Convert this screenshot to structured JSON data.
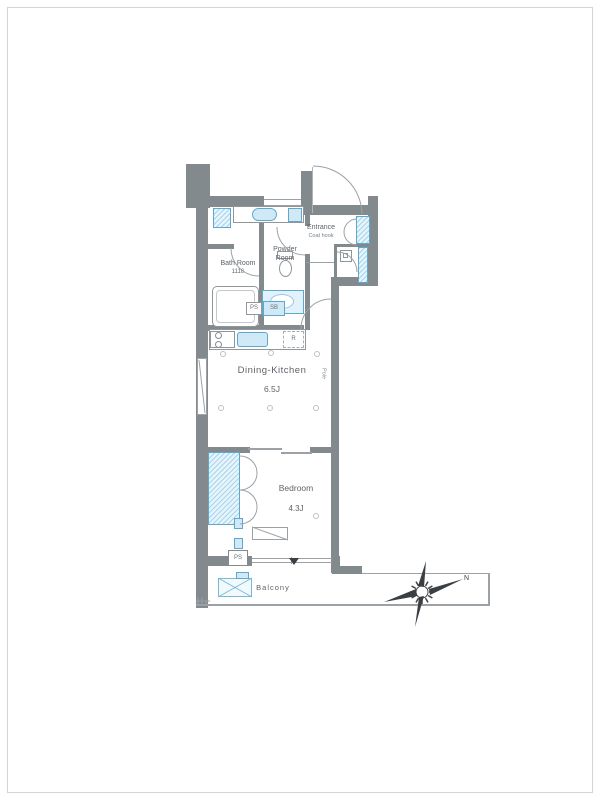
{
  "rooms": {
    "dining_kitchen": {
      "name": "Dining-Kitchen",
      "size": "6.5J"
    },
    "bedroom": {
      "name": "Bedroom",
      "size": "4.3J"
    },
    "bath": {
      "name": "Bath Room",
      "size": "1116"
    },
    "powder": {
      "name_line1": "Powder",
      "name_line2": "Room"
    },
    "entrance": {
      "name": "Entrance",
      "note": "Coat hook"
    },
    "balcony": {
      "name": "Balcony"
    }
  },
  "fixtures": {
    "ps_upper": "PS",
    "sb_box": "SB",
    "refrigerator_mark": "R",
    "ps_lower": "PS",
    "pole_note": "Pole"
  },
  "compass": {
    "north_label": "N"
  },
  "colors": {
    "wall": "#838a8e",
    "fixture_blue": "#cfe9f6",
    "fixture_blue_border": "#5fa8cc",
    "label_text": "#5d6368"
  }
}
